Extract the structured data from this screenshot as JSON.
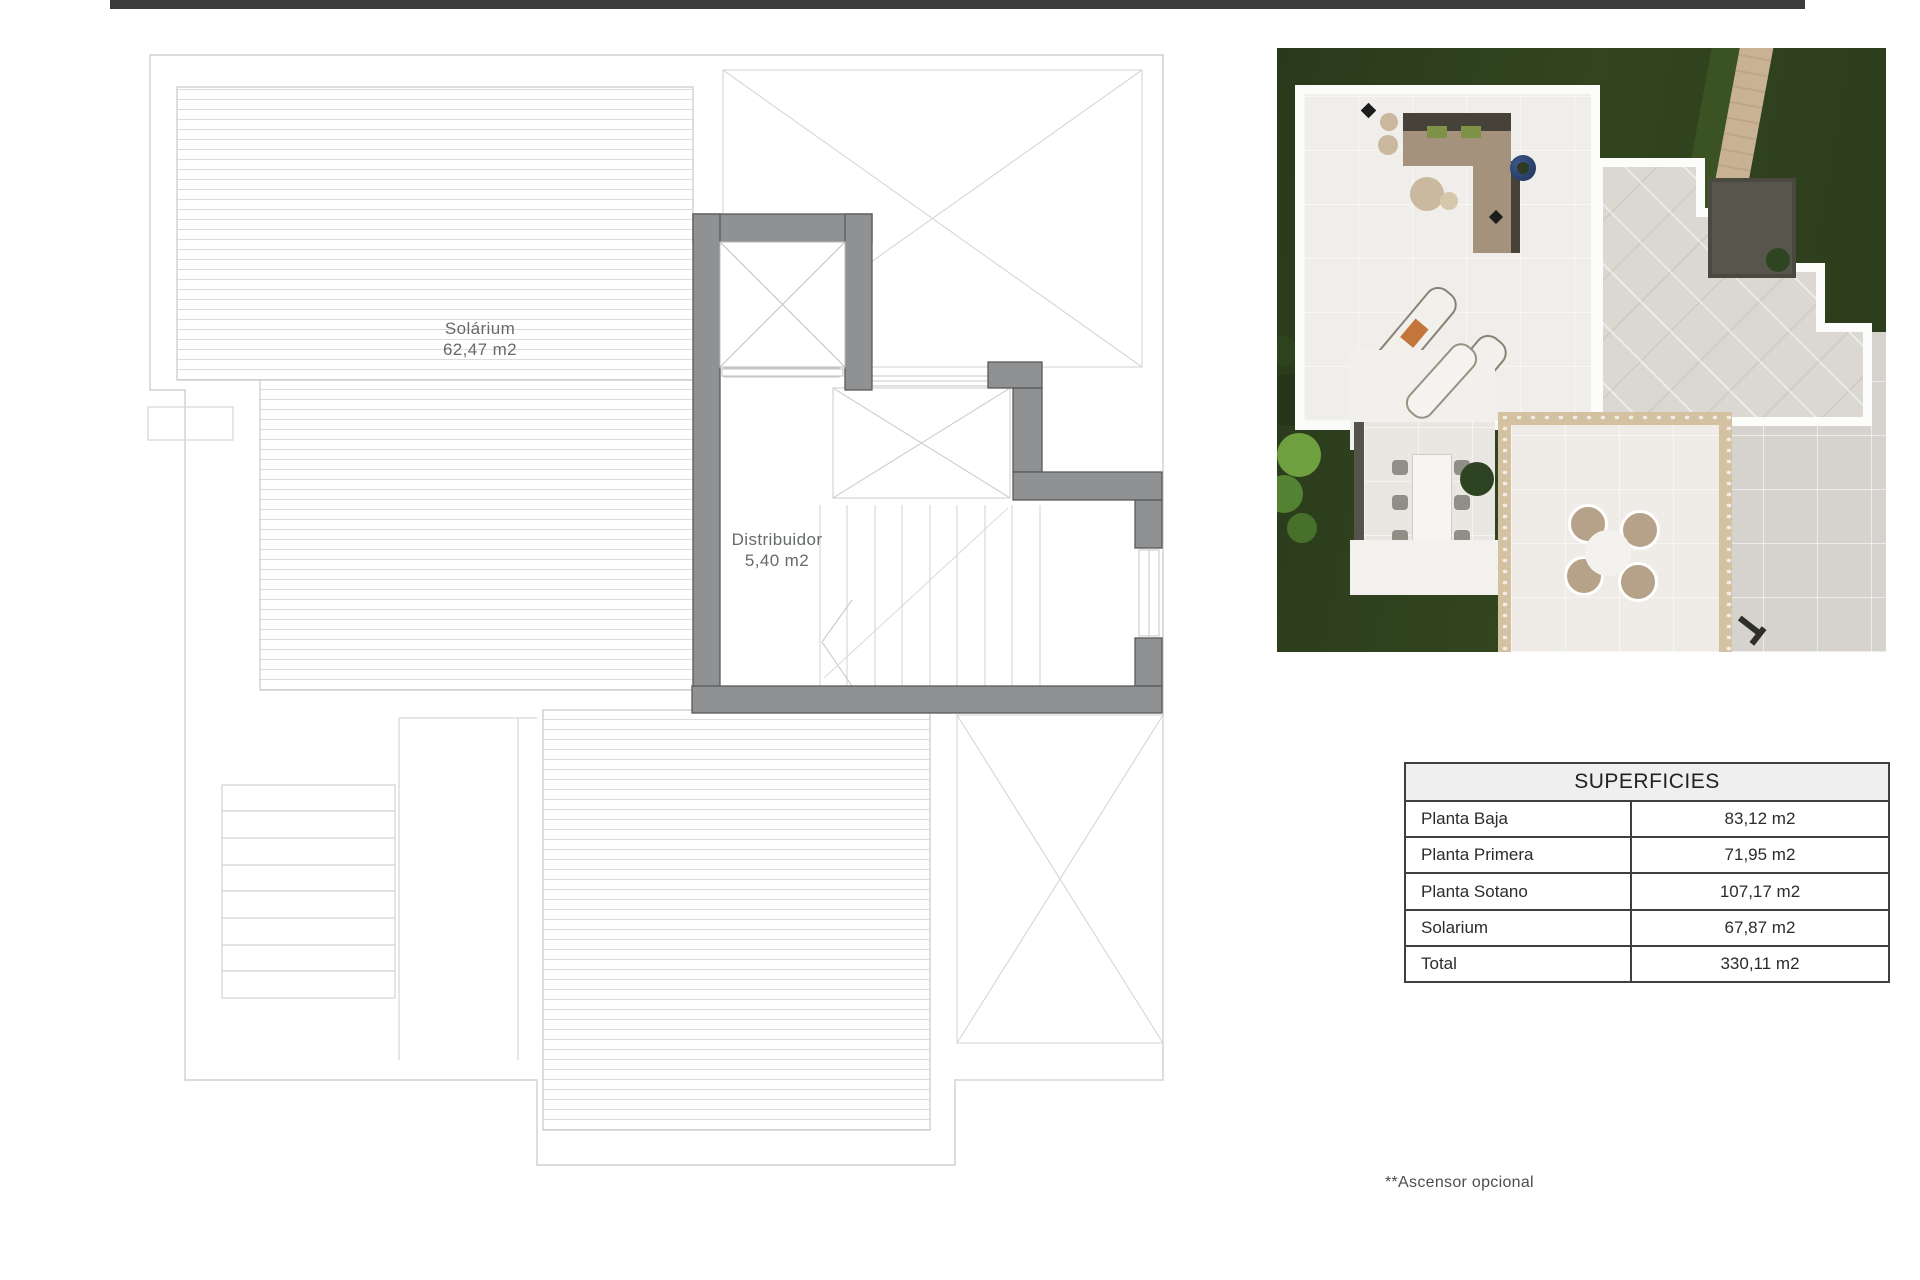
{
  "plan": {
    "solarium_label": {
      "line1": "Solárium",
      "line2": "62,47 m2"
    },
    "distribuidor_label": {
      "line1": "Distribuidor",
      "line2": "5,40 m2"
    }
  },
  "table": {
    "title": "SUPERFICIES",
    "rows": [
      {
        "label": "Planta Baja",
        "value": "83,12 m2"
      },
      {
        "label": "Planta Primera",
        "value": "71,95 m2"
      },
      {
        "label": "Planta Sotano",
        "value": "107,17 m2"
      },
      {
        "label": "Solarium",
        "value": "67,87 m2"
      },
      {
        "label": "Total",
        "value": "330,11 m2"
      }
    ]
  },
  "footnote": "**Ascensor opcional",
  "colors": {
    "top_bar": "#3b3b3b",
    "plan_wall_gray": "#8f9193",
    "plan_line_gray": "#cfcfcf",
    "plan_text_gray": "#666a6a",
    "table_border": "#3f3f3f",
    "table_header_bg": "#f0efef",
    "photo_lawn_green": "#2e4220",
    "photo_terrace_white": "#f4f2ee",
    "photo_tile_gray": "#dbd7d1",
    "photo_travertine": "#d3c1a2",
    "photo_cushion_orange": "#c2763b",
    "photo_pot_blue": "#2b3f6e"
  }
}
